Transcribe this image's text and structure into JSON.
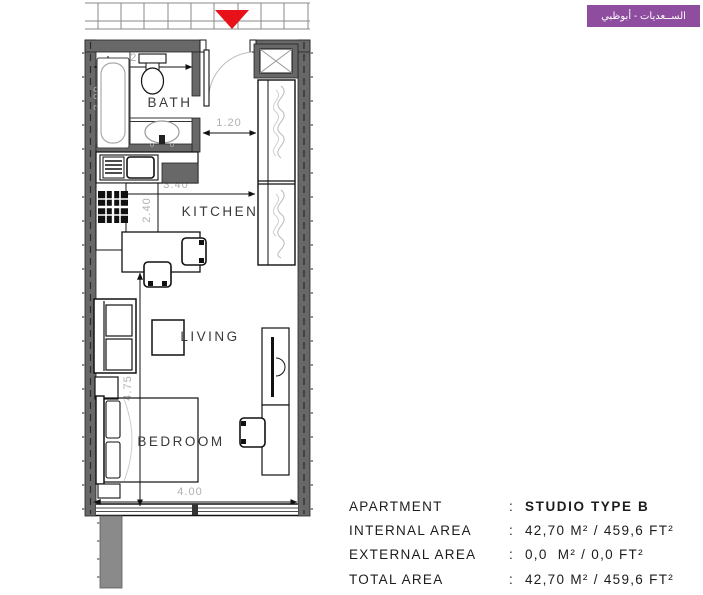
{
  "logo": {
    "text": "الســعديات - أبوظبي",
    "bg_color": "#8e4d9e"
  },
  "floor_plan": {
    "rooms": [
      {
        "label": "BATH"
      },
      {
        "label": "KITCHEN"
      },
      {
        "label": "LIVING"
      },
      {
        "label": "BEDROOM"
      }
    ],
    "dimensions": {
      "bath_width": "2.15",
      "bath_length": "2.00",
      "entry_width": "1.20",
      "kitchen_width": "3.40",
      "kitchen_length": "2.40",
      "living_bedroom_length": "4.75",
      "bedroom_width": "4.00"
    },
    "colors": {
      "wall": "#686868",
      "entrance_marker": "#e8111a",
      "dim_text": "#b0b0b0",
      "room_label": "#3a3a3a"
    }
  },
  "info_table": {
    "rows": [
      {
        "label": "APARTMENT",
        "sep": ":",
        "value": "STUDIO TYPE B"
      },
      {
        "label": "INTERNAL AREA",
        "sep": ":",
        "value": "42,70 M² / 459,6 FT²"
      },
      {
        "label": "EXTERNAL AREA",
        "sep": ":",
        "value": "0,0  M² / 0,0 FT²"
      },
      {
        "label": "TOTAL AREA",
        "sep": ":",
        "value": "42,70 M² / 459,6 FT²"
      }
    ]
  }
}
